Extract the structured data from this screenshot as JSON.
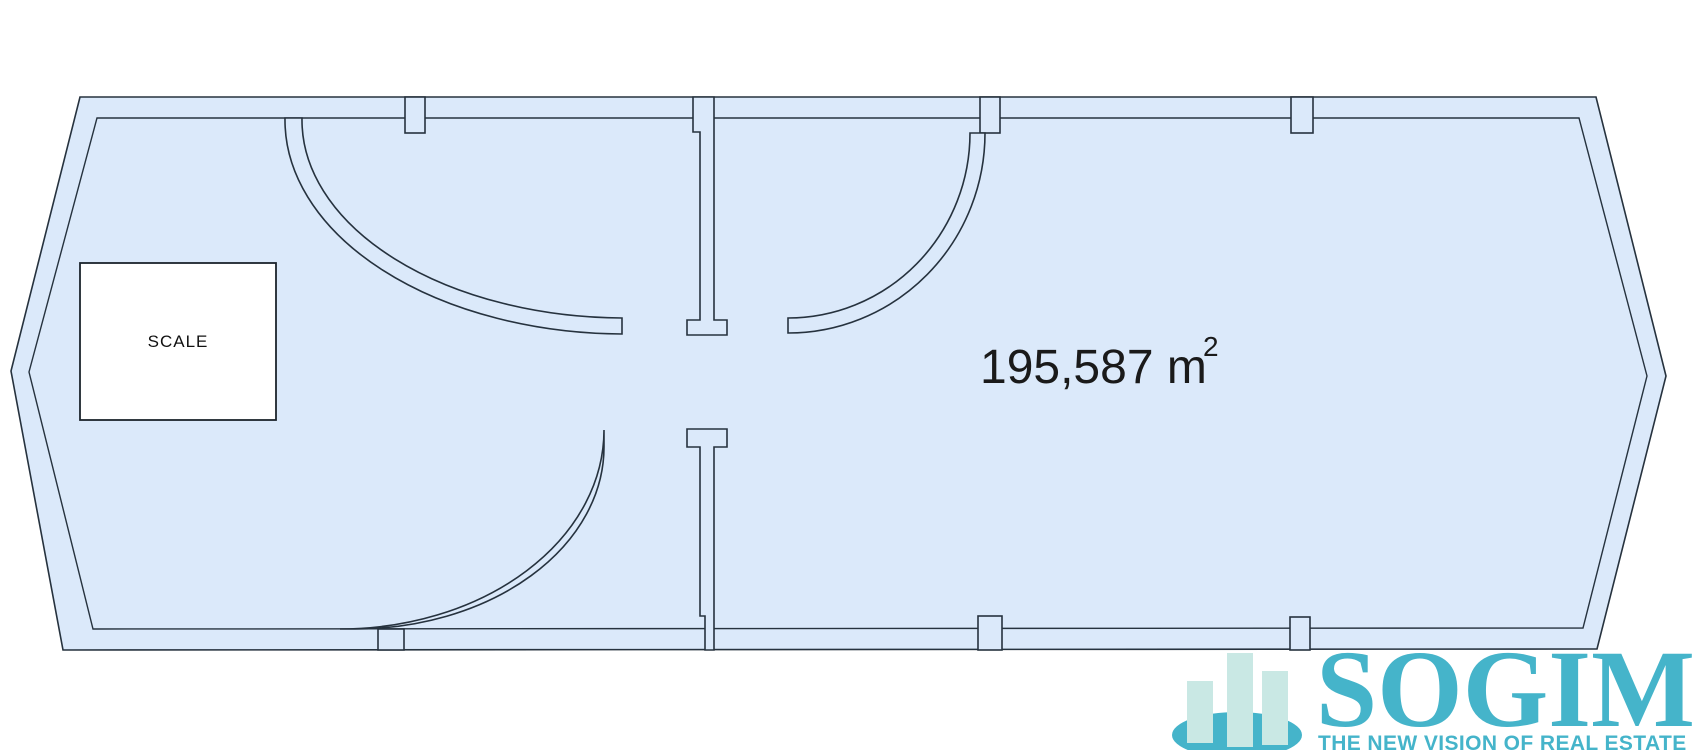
{
  "plan": {
    "scale_box_label": "SCALE",
    "area_label": {
      "value": "195,587 m",
      "sup": "2"
    }
  },
  "logo": {
    "name": "SOGIM",
    "tagline": "THE NEW VISION OF REAL ESTATE"
  },
  "colors": {
    "room_fill": "#dbe9fa",
    "line": "#26323e",
    "area_text": "#1a1a1a",
    "brand_teal": "#45b4ca",
    "brand_light": "#c9e8e4"
  }
}
